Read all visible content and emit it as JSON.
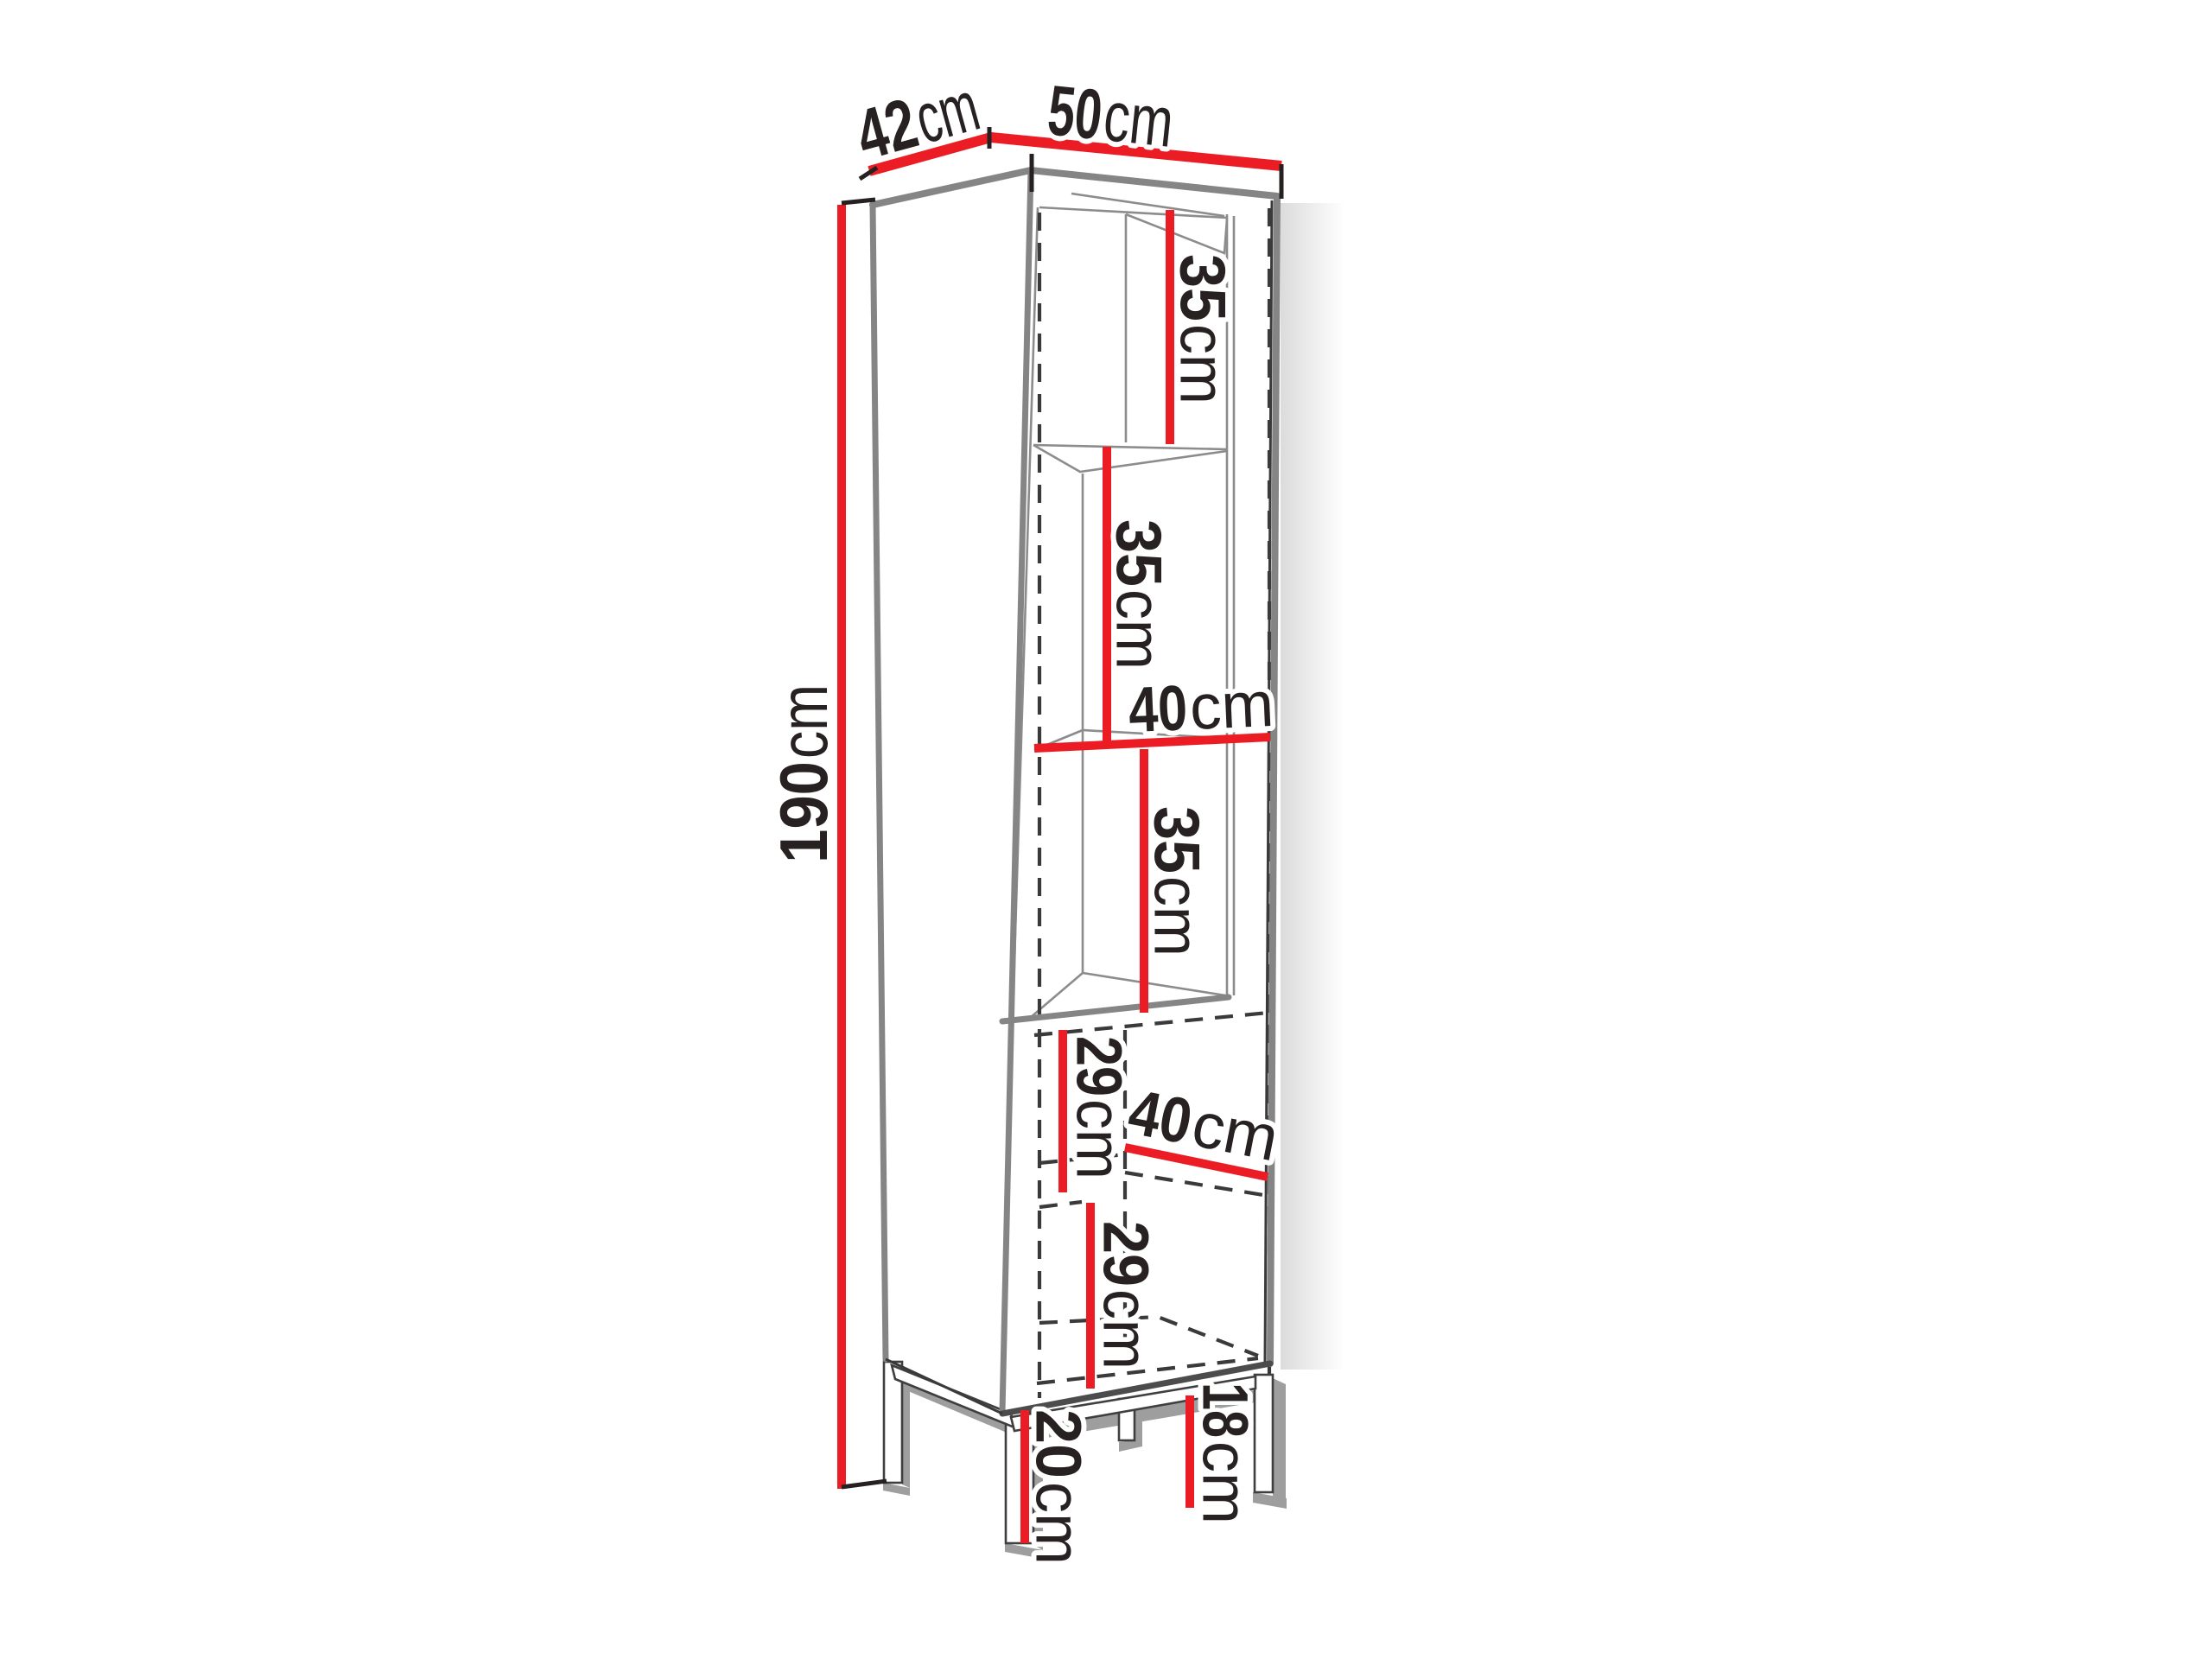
{
  "diagram": {
    "title": "cabinet-dimension-diagram",
    "subject": "tall display cabinet with three open shelf compartments, lower two-shelf door section and metal frame legs",
    "unit": "cm",
    "colors": {
      "dimension_line": "#ec1c24",
      "edge_gray": "#858585",
      "hidden_dash": "#3a3a3a",
      "text": "#272122",
      "background": "#ffffff"
    }
  },
  "labels": {
    "depth": {
      "num": "42",
      "unit": "cm"
    },
    "width": {
      "num": "50",
      "unit": "cm"
    },
    "height": {
      "num": "190",
      "unit": "cm"
    },
    "shelf_top": {
      "num": "35",
      "unit": "cm"
    },
    "shelf_upper": {
      "num": "35",
      "unit": "cm"
    },
    "inner_width": {
      "num": "40",
      "unit": "cm"
    },
    "shelf_lower": {
      "num": "35",
      "unit": "cm"
    },
    "door_upper": {
      "num": "29",
      "unit": "cm"
    },
    "door_depth": {
      "num": "40",
      "unit": "cm"
    },
    "door_lower": {
      "num": "29",
      "unit": "cm"
    },
    "leg_back": {
      "num": "18",
      "unit": "cm"
    },
    "leg_front": {
      "num": "20",
      "unit": "cm"
    }
  }
}
